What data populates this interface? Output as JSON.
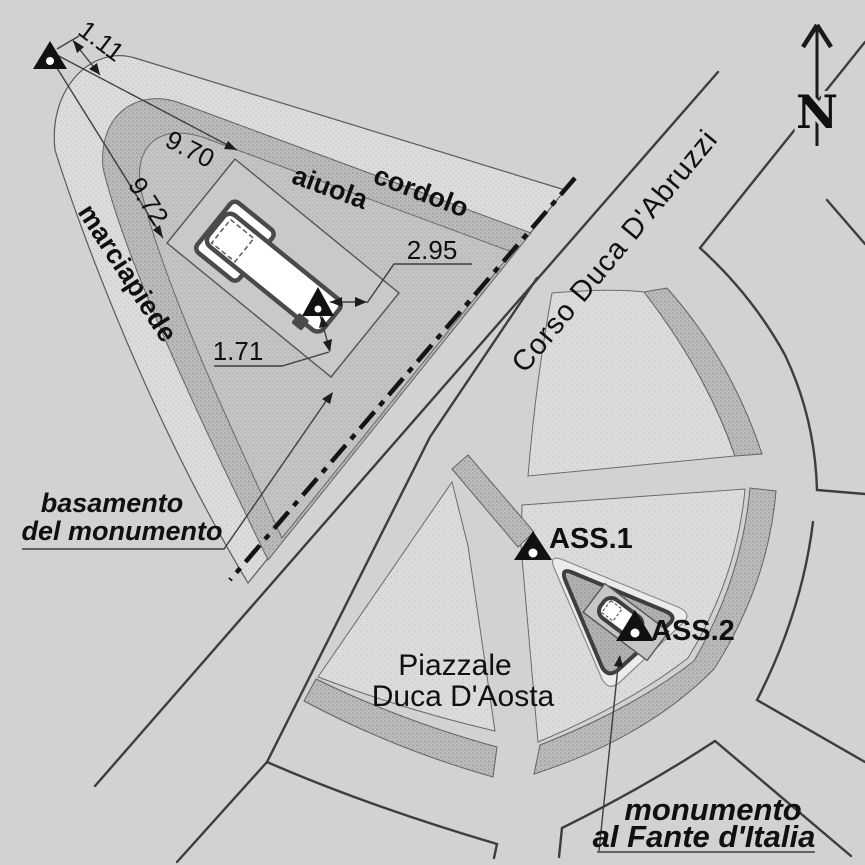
{
  "plan": {
    "north_label": "N",
    "streets": {
      "corso": "Corso Duca D'Abruzzi"
    },
    "piazza": {
      "line1": "Piazzale",
      "line2": "Duca D'Aosta"
    },
    "features": {
      "marciapiede": "marciapiede",
      "aiuola": "aiuola",
      "cordolo": "cordolo",
      "basamento_line1": "basamento",
      "basamento_line2": "del monumento",
      "monumento_line1": "monumento",
      "monumento_line2": "al Fante d'Italia"
    },
    "stations": {
      "ass1": "ASS.1",
      "ass2": "ASS.2"
    },
    "dimensions": {
      "marker_offset": "1.11",
      "to_north_corner": "9.70",
      "to_west_corner": "9.72",
      "east_offset": "2.95",
      "south_offset": "1.71"
    },
    "colors": {
      "background": "#d2d2d2",
      "sidewalk": "#dcdcdc",
      "curb_band": "#bcbcbc",
      "flowerbed": "#c5c5c5",
      "lawn": "#dbdbdb",
      "island": "#b3b3b3",
      "monument_fill": "#ffffff",
      "line": "#3d3d3d",
      "text": "#101010"
    }
  }
}
